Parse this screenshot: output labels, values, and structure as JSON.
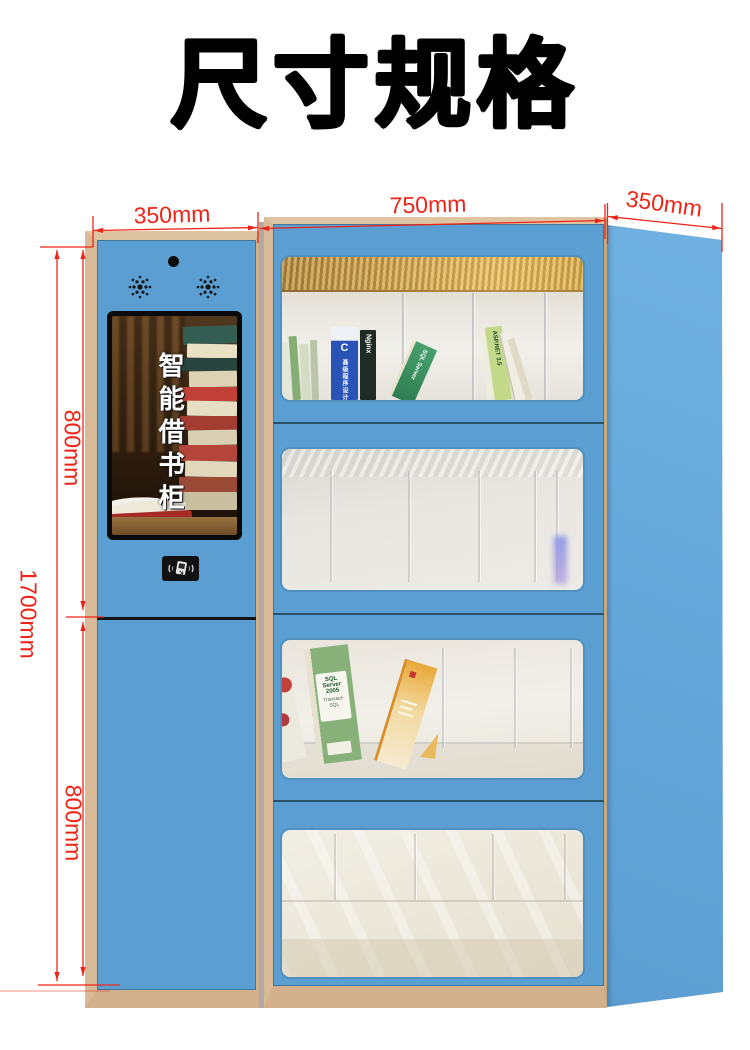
{
  "title": "尺寸规格",
  "dimension_labels": {
    "left_column_width": "350mm",
    "cabinet_width": "750mm",
    "cabinet_depth": "350mm",
    "total_height": "1700mm",
    "upper_section_height": "800mm",
    "lower_section_height": "800mm"
  },
  "kiosk": {
    "screen_caption": "智能借书柜"
  },
  "books": {
    "c_primer": "C",
    "c_primer_series": "高级程序设计",
    "nginx": "Nginx",
    "sql_server": "SQL Server",
    "aspnet": "ASP.NET 3.5",
    "sql_server_2005": "SQL Server 2005",
    "transact_sql": "Transact-SQL"
  },
  "colors": {
    "cabinet_blue": "#5B9FD2",
    "cabinet_side_blue": "#68ABDD",
    "wood_trim": "#D5B592",
    "dimension_red": "#EE2418"
  }
}
